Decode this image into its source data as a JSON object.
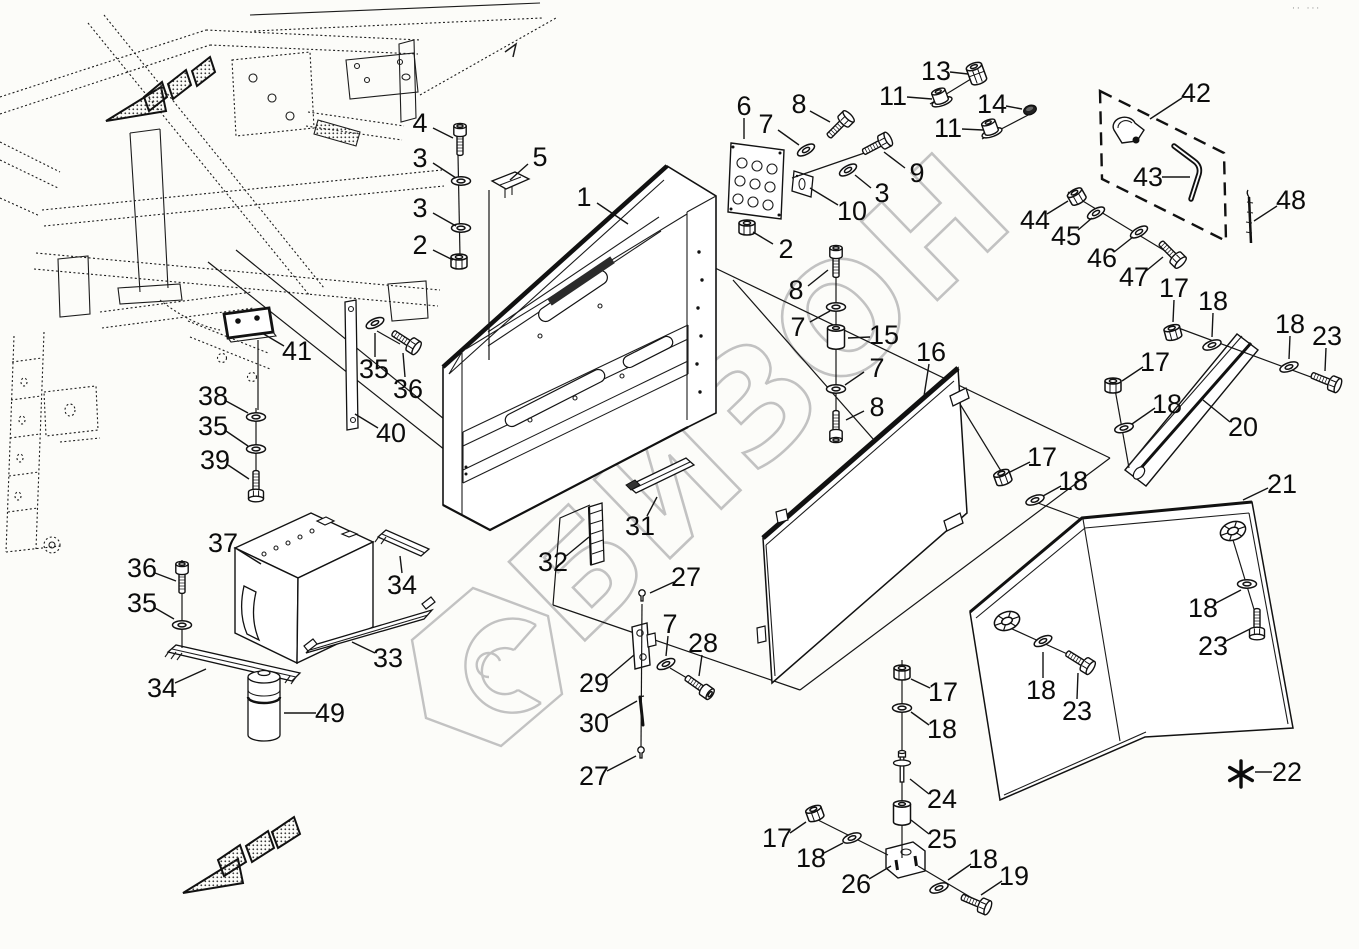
{
  "watermark": {
    "text": "БИЗОН",
    "color": "#c2c2c2"
  },
  "corner_marks": "·· ···",
  "footnote": {
    "symbol": "*",
    "label": "22"
  },
  "diagram": {
    "type": "exploded-parts-diagram",
    "part_numbers_visible": [
      "1",
      "2",
      "3",
      "4",
      "5",
      "6",
      "7",
      "8",
      "9",
      "10",
      "11",
      "13",
      "14",
      "15",
      "16",
      "17",
      "18",
      "19",
      "20",
      "21",
      "22",
      "23",
      "24",
      "25",
      "26",
      "27",
      "28",
      "29",
      "30",
      "31",
      "32",
      "33",
      "34",
      "35",
      "36",
      "37",
      "38",
      "39",
      "40",
      "41",
      "42",
      "43",
      "44",
      "45",
      "46",
      "47",
      "48",
      "49"
    ]
  },
  "callouts": [
    {
      "n": "4",
      "x": 420,
      "y": 123,
      "l": [
        433,
        128,
        453,
        138
      ]
    },
    {
      "n": "3",
      "x": 420,
      "y": 158,
      "l": [
        433,
        163,
        456,
        178
      ]
    },
    {
      "n": "3",
      "x": 420,
      "y": 208,
      "l": [
        433,
        213,
        456,
        226
      ]
    },
    {
      "n": "2",
      "x": 420,
      "y": 245,
      "l": [
        433,
        250,
        453,
        260
      ]
    },
    {
      "n": "5",
      "x": 540,
      "y": 157,
      "l": [
        528,
        164,
        510,
        180
      ]
    },
    {
      "n": "1",
      "x": 584,
      "y": 197,
      "l": [
        597,
        203,
        628,
        224
      ]
    },
    {
      "n": "6",
      "x": 744,
      "y": 106,
      "l": [
        744,
        118,
        744,
        139
      ]
    },
    {
      "n": "7",
      "x": 766,
      "y": 124,
      "l": [
        778,
        130,
        799,
        145
      ]
    },
    {
      "n": "8",
      "x": 799,
      "y": 104,
      "l": [
        810,
        111,
        830,
        122
      ]
    },
    {
      "n": "9",
      "x": 917,
      "y": 173,
      "l": [
        905,
        168,
        884,
        152
      ]
    },
    {
      "n": "3",
      "x": 882,
      "y": 193,
      "l": [
        871,
        188,
        855,
        175
      ]
    },
    {
      "n": "10",
      "x": 852,
      "y": 211,
      "l": [
        838,
        205,
        810,
        188
      ]
    },
    {
      "n": "2",
      "x": 786,
      "y": 249,
      "l": [
        773,
        244,
        753,
        232
      ]
    },
    {
      "n": "13",
      "x": 936,
      "y": 71,
      "l": [
        950,
        72,
        968,
        74
      ]
    },
    {
      "n": "11",
      "x": 893,
      "y": 96,
      "l": [
        907,
        97,
        932,
        99
      ]
    },
    {
      "n": "14",
      "x": 992,
      "y": 104,
      "l": [
        1006,
        106,
        1022,
        109
      ]
    },
    {
      "n": "11",
      "x": 948,
      "y": 128,
      "l": [
        962,
        129,
        983,
        130
      ]
    },
    {
      "n": "42",
      "x": 1196,
      "y": 93,
      "l": [
        1182,
        98,
        1150,
        119
      ]
    },
    {
      "n": "43",
      "x": 1148,
      "y": 177,
      "l": [
        1162,
        177,
        1190,
        177
      ]
    },
    {
      "n": "48",
      "x": 1291,
      "y": 200,
      "l": [
        1277,
        206,
        1254,
        221
      ]
    },
    {
      "n": "44",
      "x": 1035,
      "y": 220,
      "l": [
        1047,
        214,
        1068,
        201
      ]
    },
    {
      "n": "45",
      "x": 1066,
      "y": 236,
      "l": [
        1078,
        230,
        1092,
        218
      ]
    },
    {
      "n": "46",
      "x": 1102,
      "y": 258,
      "l": [
        1114,
        252,
        1133,
        237
      ]
    },
    {
      "n": "47",
      "x": 1134,
      "y": 277,
      "l": [
        1146,
        271,
        1163,
        257
      ]
    },
    {
      "n": "8",
      "x": 796,
      "y": 290,
      "l": [
        808,
        286,
        828,
        270
      ]
    },
    {
      "n": "7",
      "x": 798,
      "y": 327,
      "l": [
        810,
        322,
        830,
        311
      ]
    },
    {
      "n": "15",
      "x": 884,
      "y": 335,
      "l": [
        870,
        337,
        848,
        338
      ]
    },
    {
      "n": "7",
      "x": 877,
      "y": 368,
      "l": [
        864,
        372,
        845,
        385
      ]
    },
    {
      "n": "8",
      "x": 877,
      "y": 407,
      "l": [
        864,
        411,
        846,
        420
      ]
    },
    {
      "n": "16",
      "x": 931,
      "y": 352,
      "l": [
        929,
        364,
        924,
        396
      ]
    },
    {
      "n": "17",
      "x": 1174,
      "y": 288,
      "l": [
        1174,
        300,
        1173,
        322
      ]
    },
    {
      "n": "18",
      "x": 1213,
      "y": 301,
      "l": [
        1213,
        313,
        1212,
        337
      ]
    },
    {
      "n": "18",
      "x": 1290,
      "y": 324,
      "l": [
        1290,
        336,
        1289,
        359
      ]
    },
    {
      "n": "23",
      "x": 1327,
      "y": 336,
      "l": [
        1326,
        348,
        1325,
        371
      ]
    },
    {
      "n": "17",
      "x": 1155,
      "y": 362,
      "l": [
        1143,
        367,
        1122,
        381
      ]
    },
    {
      "n": "18",
      "x": 1167,
      "y": 404,
      "l": [
        1155,
        408,
        1132,
        424
      ]
    },
    {
      "n": "20",
      "x": 1243,
      "y": 427,
      "l": [
        1230,
        422,
        1203,
        400
      ]
    },
    {
      "n": "21",
      "x": 1282,
      "y": 484,
      "l": [
        1268,
        488,
        1243,
        500
      ]
    },
    {
      "n": "17",
      "x": 1042,
      "y": 457,
      "l": [
        1030,
        462,
        1010,
        472
      ]
    },
    {
      "n": "18",
      "x": 1073,
      "y": 481,
      "l": [
        1061,
        486,
        1043,
        496
      ]
    },
    {
      "n": "27",
      "x": 686,
      "y": 577,
      "l": [
        674,
        582,
        650,
        593
      ]
    },
    {
      "n": "7",
      "x": 670,
      "y": 624,
      "l": [
        668,
        636,
        666,
        656
      ]
    },
    {
      "n": "28",
      "x": 703,
      "y": 643,
      "l": [
        702,
        655,
        699,
        676
      ]
    },
    {
      "n": "29",
      "x": 594,
      "y": 683,
      "l": [
        607,
        678,
        634,
        655
      ]
    },
    {
      "n": "30",
      "x": 594,
      "y": 723,
      "l": [
        607,
        718,
        637,
        701
      ]
    },
    {
      "n": "27",
      "x": 594,
      "y": 776,
      "l": [
        607,
        771,
        636,
        756
      ]
    },
    {
      "n": "31",
      "x": 640,
      "y": 526,
      "l": [
        647,
        516,
        657,
        497
      ]
    },
    {
      "n": "32",
      "x": 553,
      "y": 562,
      "l": [
        566,
        556,
        589,
        537
      ]
    },
    {
      "n": "41",
      "x": 297,
      "y": 351,
      "l": [
        284,
        346,
        262,
        333
      ]
    },
    {
      "n": "38",
      "x": 213,
      "y": 396,
      "l": [
        226,
        401,
        248,
        413
      ]
    },
    {
      "n": "35",
      "x": 213,
      "y": 426,
      "l": [
        226,
        431,
        248,
        446
      ]
    },
    {
      "n": "39",
      "x": 215,
      "y": 460,
      "l": [
        228,
        465,
        249,
        479
      ]
    },
    {
      "n": "35",
      "x": 374,
      "y": 369,
      "l": [
        375,
        357,
        375,
        333
      ]
    },
    {
      "n": "36",
      "x": 408,
      "y": 389,
      "l": [
        405,
        377,
        403,
        353
      ]
    },
    {
      "n": "40",
      "x": 391,
      "y": 433,
      "l": [
        378,
        428,
        355,
        414
      ]
    },
    {
      "n": "37",
      "x": 223,
      "y": 543,
      "l": [
        237,
        549,
        261,
        564
      ]
    },
    {
      "n": "36",
      "x": 142,
      "y": 568,
      "l": [
        155,
        573,
        176,
        581
      ]
    },
    {
      "n": "35",
      "x": 142,
      "y": 603,
      "l": [
        155,
        608,
        174,
        619
      ]
    },
    {
      "n": "34",
      "x": 162,
      "y": 688,
      "l": [
        175,
        683,
        206,
        669
      ]
    },
    {
      "n": "34",
      "x": 402,
      "y": 585,
      "l": [
        402,
        573,
        400,
        556
      ]
    },
    {
      "n": "33",
      "x": 388,
      "y": 658,
      "l": [
        375,
        653,
        352,
        642
      ]
    },
    {
      "n": "49",
      "x": 330,
      "y": 713,
      "l": [
        316,
        713,
        284,
        713
      ]
    },
    {
      "n": "17",
      "x": 943,
      "y": 692,
      "l": [
        930,
        688,
        911,
        679
      ]
    },
    {
      "n": "18",
      "x": 942,
      "y": 729,
      "l": [
        929,
        725,
        911,
        712
      ]
    },
    {
      "n": "24",
      "x": 942,
      "y": 799,
      "l": [
        929,
        794,
        910,
        779
      ]
    },
    {
      "n": "25",
      "x": 942,
      "y": 839,
      "l": [
        929,
        834,
        911,
        820
      ]
    },
    {
      "n": "26",
      "x": 856,
      "y": 884,
      "l": [
        869,
        879,
        891,
        866
      ]
    },
    {
      "n": "17",
      "x": 777,
      "y": 838,
      "l": [
        790,
        833,
        806,
        822
      ]
    },
    {
      "n": "18",
      "x": 811,
      "y": 858,
      "l": [
        824,
        853,
        843,
        843
      ]
    },
    {
      "n": "18",
      "x": 983,
      "y": 859,
      "l": [
        971,
        864,
        948,
        880
      ]
    },
    {
      "n": "19",
      "x": 1014,
      "y": 876,
      "l": [
        1002,
        881,
        981,
        895
      ]
    },
    {
      "n": "18",
      "x": 1203,
      "y": 608,
      "l": [
        1216,
        603,
        1241,
        590
      ]
    },
    {
      "n": "23",
      "x": 1213,
      "y": 646,
      "l": [
        1226,
        641,
        1250,
        629
      ]
    },
    {
      "n": "18",
      "x": 1041,
      "y": 690,
      "l": [
        1043,
        678,
        1043,
        652
      ]
    },
    {
      "n": "23",
      "x": 1077,
      "y": 711,
      "l": [
        1077,
        699,
        1078,
        673
      ]
    },
    {
      "n": "22",
      "x": 1287,
      "y": 772,
      "l": [
        1272,
        772,
        1255,
        772
      ]
    }
  ],
  "hardware": [
    {
      "t": "boltS",
      "x": 460,
      "y": 142,
      "r": 0
    },
    {
      "t": "washer",
      "x": 461,
      "y": 181,
      "r": 0
    },
    {
      "t": "washer",
      "x": 461,
      "y": 228,
      "r": 0
    },
    {
      "t": "nut",
      "x": 459,
      "y": 262,
      "r": 0
    },
    {
      "t": "washer",
      "x": 806,
      "y": 150,
      "r": -30
    },
    {
      "t": "bolt",
      "x": 838,
      "y": 127,
      "r": 45
    },
    {
      "t": "bolt",
      "x": 875,
      "y": 146,
      "r": 62
    },
    {
      "t": "washer",
      "x": 848,
      "y": 170,
      "r": -30
    },
    {
      "t": "nut",
      "x": 747,
      "y": 228,
      "r": 0
    },
    {
      "t": "locknut",
      "x": 977,
      "y": 75,
      "r": -20
    },
    {
      "t": "flangenut",
      "x": 941,
      "y": 99,
      "r": -20
    },
    {
      "t": "capnut",
      "x": 1030,
      "y": 110,
      "r": -20
    },
    {
      "t": "flangenut",
      "x": 991,
      "y": 130,
      "r": -20
    },
    {
      "t": "nut",
      "x": 1077,
      "y": 197,
      "r": -30
    },
    {
      "t": "washer",
      "x": 1096,
      "y": 213,
      "r": -30
    },
    {
      "t": "washer",
      "x": 1139,
      "y": 232,
      "r": -30
    },
    {
      "t": "bolt",
      "x": 1170,
      "y": 252,
      "r": 135
    },
    {
      "t": "boltS",
      "x": 836,
      "y": 264,
      "r": 0
    },
    {
      "t": "washer",
      "x": 836,
      "y": 307,
      "r": 0
    },
    {
      "t": "spacer",
      "x": 836,
      "y": 337,
      "r": 0
    },
    {
      "t": "washer",
      "x": 836,
      "y": 389,
      "r": 0
    },
    {
      "t": "boltS",
      "x": 836,
      "y": 424,
      "r": 180
    },
    {
      "t": "nut",
      "x": 1003,
      "y": 478,
      "r": -20
    },
    {
      "t": "washer",
      "x": 1035,
      "y": 500,
      "r": -20
    },
    {
      "t": "nut",
      "x": 1113,
      "y": 386,
      "r": 0
    },
    {
      "t": "washer",
      "x": 1124,
      "y": 428,
      "r": -15
    },
    {
      "t": "nut",
      "x": 1173,
      "y": 333,
      "r": -15
    },
    {
      "t": "washer",
      "x": 1212,
      "y": 345,
      "r": -20
    },
    {
      "t": "washer",
      "x": 1289,
      "y": 367,
      "r": -20
    },
    {
      "t": "bolt",
      "x": 1324,
      "y": 380,
      "r": 112
    },
    {
      "t": "screwhead",
      "x": 1233,
      "y": 531,
      "r": -20
    },
    {
      "t": "washer",
      "x": 1247,
      "y": 584,
      "r": 0
    },
    {
      "t": "bolt",
      "x": 1257,
      "y": 622,
      "r": 180
    },
    {
      "t": "screwhead",
      "x": 1007,
      "y": 621,
      "r": -20
    },
    {
      "t": "washer",
      "x": 1043,
      "y": 641,
      "r": -25
    },
    {
      "t": "bolt",
      "x": 1078,
      "y": 660,
      "r": 122
    },
    {
      "t": "nut",
      "x": 902,
      "y": 673,
      "r": 0
    },
    {
      "t": "washer",
      "x": 902,
      "y": 708,
      "r": 0
    },
    {
      "t": "pin24",
      "x": 902,
      "y": 768,
      "r": 0
    },
    {
      "t": "spacer",
      "x": 902,
      "y": 813,
      "r": 0
    },
    {
      "t": "nut",
      "x": 815,
      "y": 814,
      "r": -20
    },
    {
      "t": "washer",
      "x": 852,
      "y": 838,
      "r": -20
    },
    {
      "t": "washer",
      "x": 939,
      "y": 888,
      "r": -20
    },
    {
      "t": "bolt",
      "x": 974,
      "y": 902,
      "r": 113
    },
    {
      "t": "boltS",
      "x": 182,
      "y": 580,
      "r": 0
    },
    {
      "t": "washer",
      "x": 182,
      "y": 625,
      "r": 0
    },
    {
      "t": "washer",
      "x": 256,
      "y": 417,
      "r": 0
    },
    {
      "t": "washer",
      "x": 256,
      "y": 449,
      "r": 0
    },
    {
      "t": "bolt",
      "x": 256,
      "y": 484,
      "r": 180
    },
    {
      "t": "washer",
      "x": 375,
      "y": 323,
      "r": -25
    },
    {
      "t": "bolt",
      "x": 404,
      "y": 340,
      "r": 123
    },
    {
      "t": "pin27",
      "x": 642,
      "y": 596,
      "r": 0
    },
    {
      "t": "washer",
      "x": 666,
      "y": 664,
      "r": -25
    },
    {
      "t": "boltS",
      "x": 697,
      "y": 685,
      "r": 125
    },
    {
      "t": "pin27",
      "x": 641,
      "y": 753,
      "r": 0
    }
  ]
}
